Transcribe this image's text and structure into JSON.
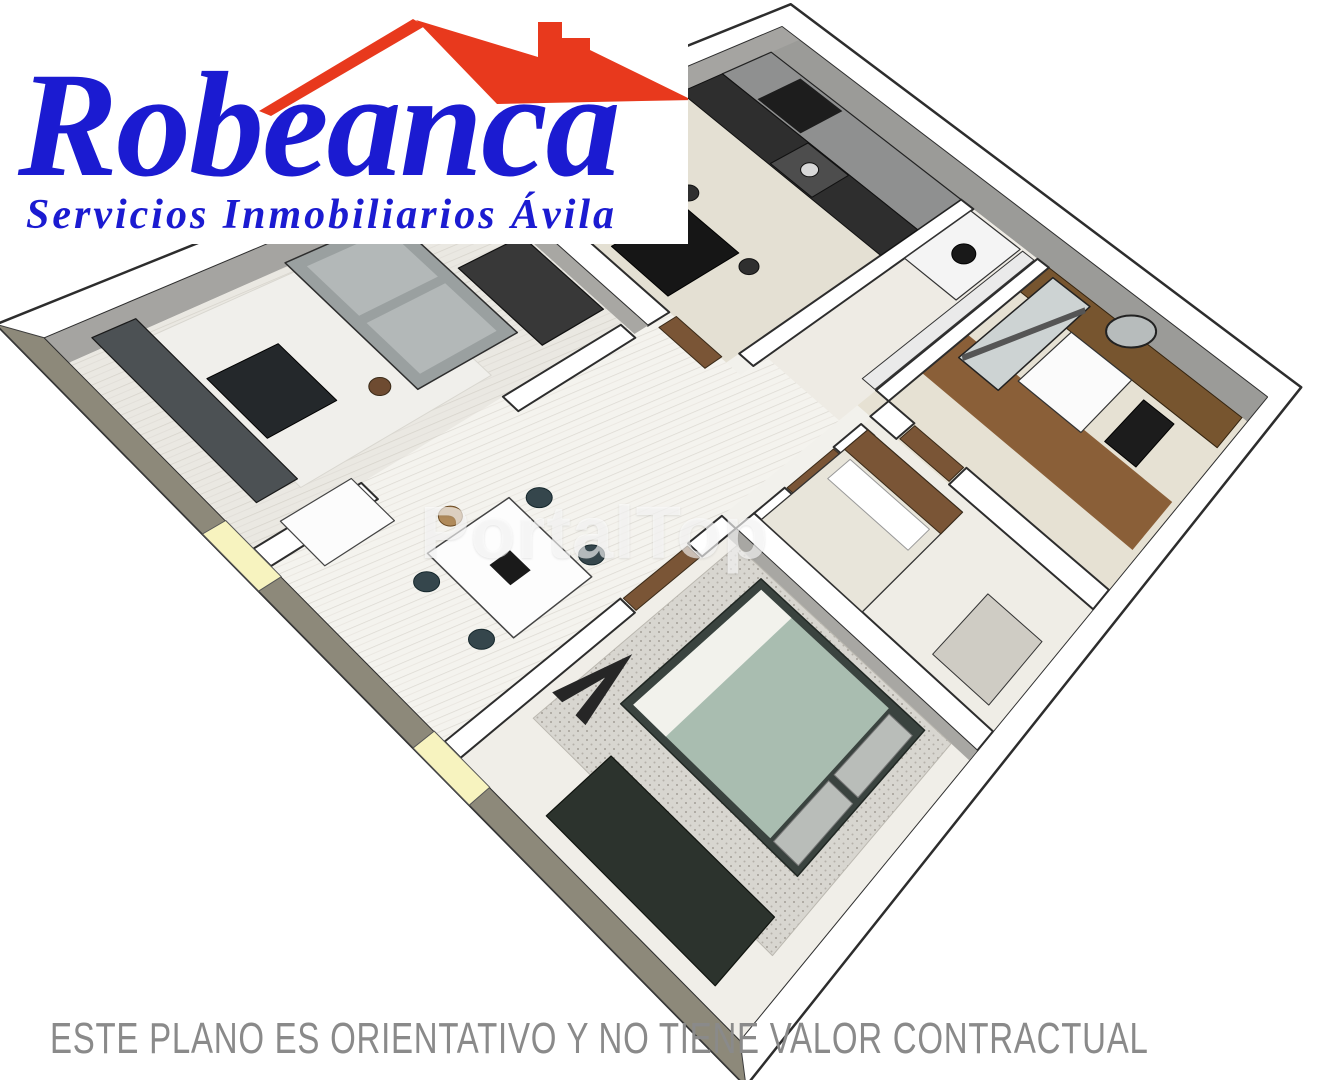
{
  "logo": {
    "brand": "Robeanca",
    "tagline": "Servicios Inmobiliarios Ávila",
    "brand_color": "#1b1bd1",
    "roof_color": "#e8391d"
  },
  "watermark": {
    "text": "PortalTop",
    "color": "rgba(255,255,255,0.62)"
  },
  "disclaimer": {
    "text": "ESTE PLANO ES ORIENTATIVO Y NO TIENE VALOR CONTRACTUAL",
    "color": "#8a8a8a"
  },
  "floor_plan": {
    "style": "3D axonometric apartment render",
    "rooms": [
      "kitchen",
      "utility-room",
      "bathroom",
      "bedroom",
      "master-bedroom",
      "living-room",
      "dining-area",
      "hallway"
    ],
    "palette": {
      "wall_top": "#ffffff",
      "wall_face": "#9b9b98",
      "facade_band": "#95917f",
      "wood_door": "#7a5536",
      "wood_floor": "#8a5f38",
      "duvet": "#a9bdb0",
      "window_sill": "#f7f3bf",
      "outline": "#2d2d2d"
    }
  }
}
